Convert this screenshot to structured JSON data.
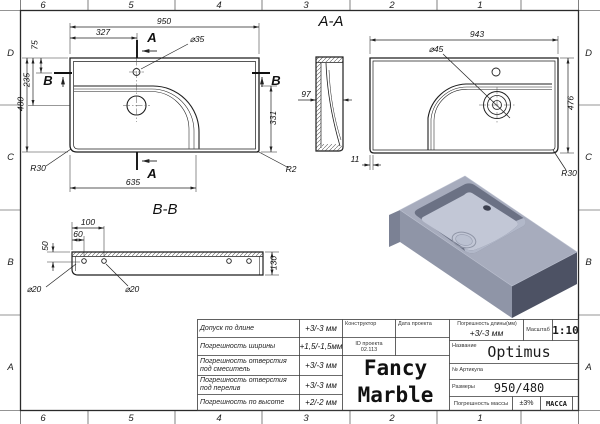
{
  "sheet": {
    "type": "engineering-drawing",
    "product": "Optimus washbasin",
    "colors": {
      "line": "#1f1f1f",
      "render_top": "#a7acbd",
      "render_front": "#8f95a7",
      "render_side": "#4d5264",
      "render_basin_floor": "#c2c7d6",
      "render_basin_wall": "#6b7184"
    }
  },
  "border": {
    "top": [
      "6",
      "5",
      "4",
      "3",
      "2",
      "1"
    ],
    "bottom": [
      "6",
      "5",
      "4",
      "3",
      "2",
      "1"
    ],
    "left": [
      "D",
      "C",
      "B",
      "A"
    ],
    "right": [
      "D",
      "C",
      "B",
      "A"
    ]
  },
  "plan": {
    "width": "950",
    "faucet_offset_x": "327",
    "faucet_offset_y": "75",
    "drain_offset_y": "235",
    "depth": "480",
    "right_height": "331",
    "basin_width": "635",
    "corner_bl": "R30",
    "corner_br": "R2",
    "faucet_hole": "⌀35",
    "section_a": "A",
    "section_b": "B"
  },
  "section_aa": {
    "title": "A-A",
    "width": "943",
    "drain_hole": "⌀45",
    "side_width": "97",
    "height": "476",
    "wall_offset": "11",
    "corner": "R30"
  },
  "section_bb": {
    "title": "B-B",
    "hole2_offset": "100",
    "hole1_offset": "60",
    "hole_depth": "50",
    "mount_hole_left": "⌀20",
    "mount_hole_right": "⌀20",
    "height": "130"
  },
  "title_block": {
    "rows": [
      {
        "label": "Допуск по длине",
        "value": "+3/-3 мм"
      },
      {
        "label": "Погрешность ширины",
        "value": "+1,5/-1,5мм"
      },
      {
        "label": "Погрешность отверстия под смеситель",
        "value": "+3/-3 мм"
      },
      {
        "label": "Погрешность отверстия под перелив",
        "value": "+3/-3 мм"
      },
      {
        "label": "Погрешность по высоте",
        "value": "+2/-2 мм"
      }
    ],
    "constructor_label": "Конструктор",
    "date_label": "Дата проекта",
    "project_id_label": "ID проекта",
    "project_id_value": "02.113",
    "logo_line1": "Fancy",
    "logo_line2": "Marble",
    "length_tol_label": "Погрешность длины(мм)",
    "length_tol_value": "+3/-3 мм",
    "scale_label": "Масштаб",
    "scale_value": "1:10",
    "name_label": "Название",
    "name_value": "Optimus",
    "article_label": "№ Артикула",
    "sizes_label": "Размеры",
    "sizes_value": "950/480",
    "mass_tol_label": "Погрешность массы",
    "mass_tol_value": "±3%",
    "mass_label": "МАССА"
  }
}
